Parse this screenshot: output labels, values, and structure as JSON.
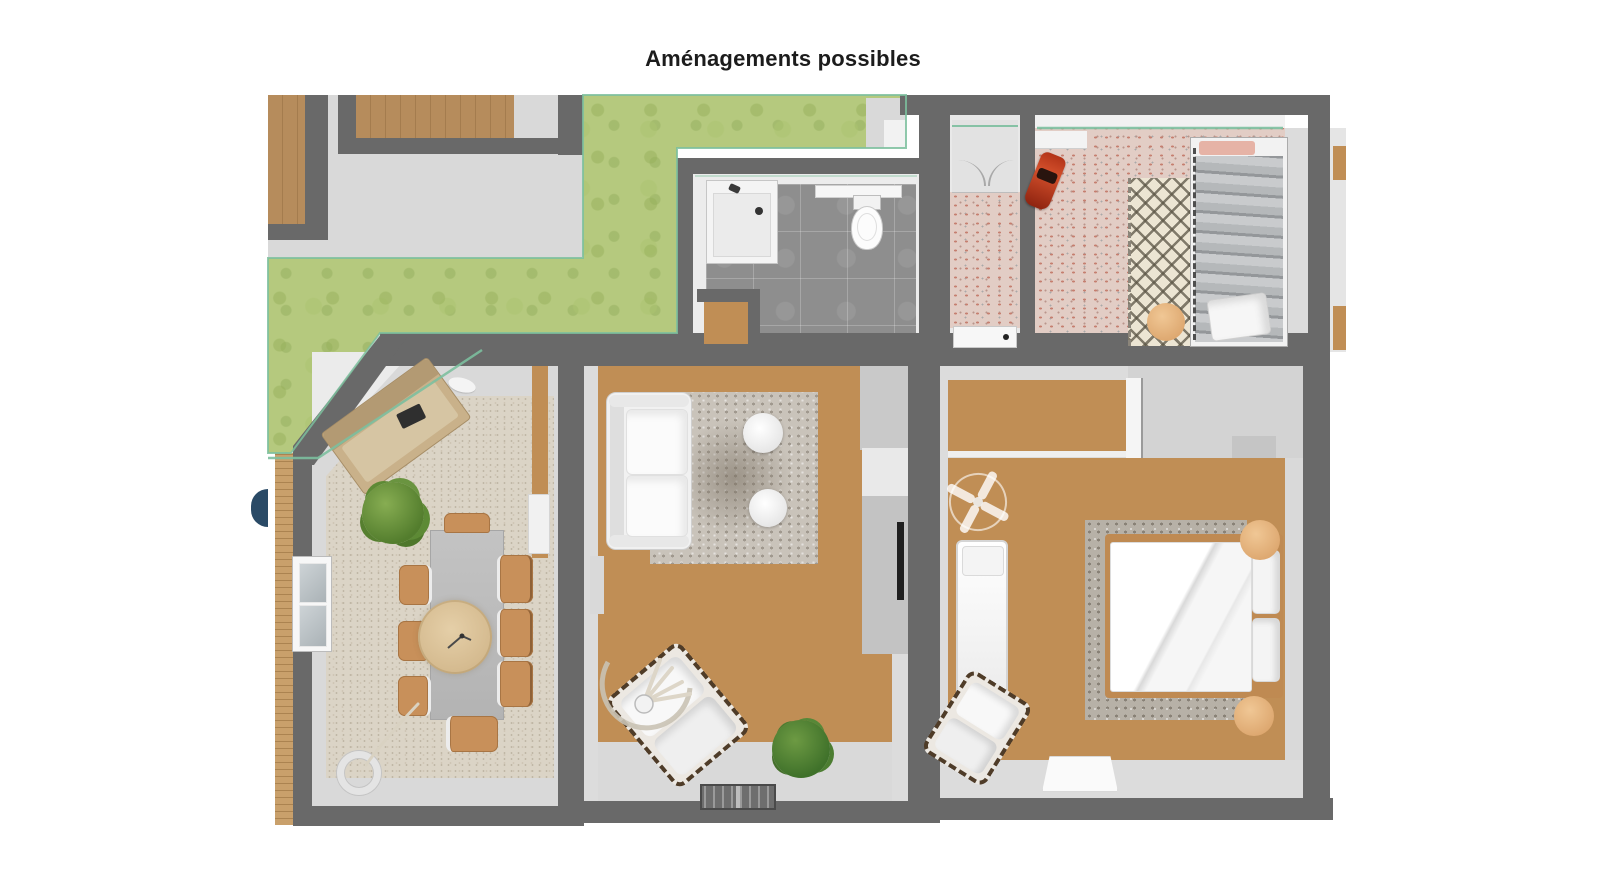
{
  "title": "Aménagements possibles",
  "figure": {
    "kind": "3D floor plan, top-down view",
    "palette": {
      "background": "#ffffff",
      "walls": "#696969",
      "floor_light_gray": "#d9d9d9",
      "wood_floor": "#c08e55",
      "grass": "#b5c97e",
      "glass_partition": "#7cbf9e",
      "bathroom_tile": "#8e8e8e",
      "pink_terrazzo": "#e2cdc5",
      "beige_rug": "#dbd4c6",
      "gray_rug": "#c9c3ba",
      "tan_pouf": "#e8bd8c",
      "toy_car_red": "#b5371c",
      "door_marker_navy": "#2a4a66"
    },
    "rooms": [
      {
        "id": "garden",
        "label": "garden lawn with neighbouring buildings and paths",
        "floor": "grass"
      },
      {
        "id": "bathroom",
        "label": "bathroom",
        "floor": "gray tile",
        "items": [
          "shower tray with drain",
          "toilet",
          "wall shelf",
          "wood storage nook"
        ]
      },
      {
        "id": "laundry",
        "label": "laundry / storage closet",
        "floor": "pink terrazzo",
        "items": [
          "wardrobe",
          "washing machine"
        ]
      },
      {
        "id": "kids-bedroom",
        "label": "kids bedroom",
        "floor": "pink terrazzo",
        "items": [
          "red toy car",
          "diamond pattern rug",
          "round pouf",
          "single bed with striped duvet",
          "pillows"
        ]
      },
      {
        "id": "dining-room",
        "label": "dining room / glazed veranda",
        "floor": "light gray with beige rug",
        "items": [
          "bench sofa",
          "green plant",
          "dining table",
          "round pendant lamp",
          "7 wooden chairs",
          "ring floor lamp",
          "window",
          "wood deck",
          "glass wall"
        ]
      },
      {
        "id": "living-room",
        "label": "living room",
        "floor": "wood",
        "items": [
          "white sofa",
          "textured rug",
          "2 round side tables",
          "TV cabinet",
          "arc lamp with dried plant",
          "armchair",
          "green plant",
          "striped doormat"
        ]
      },
      {
        "id": "master-bedroom",
        "label": "master bedroom",
        "floor": "wood and light gray",
        "items": [
          "ceiling fan",
          "single daybed",
          "armchair",
          "double bed",
          "2 tan bedside poufs",
          "textured rug",
          "white bench mat",
          "closet"
        ]
      }
    ]
  }
}
